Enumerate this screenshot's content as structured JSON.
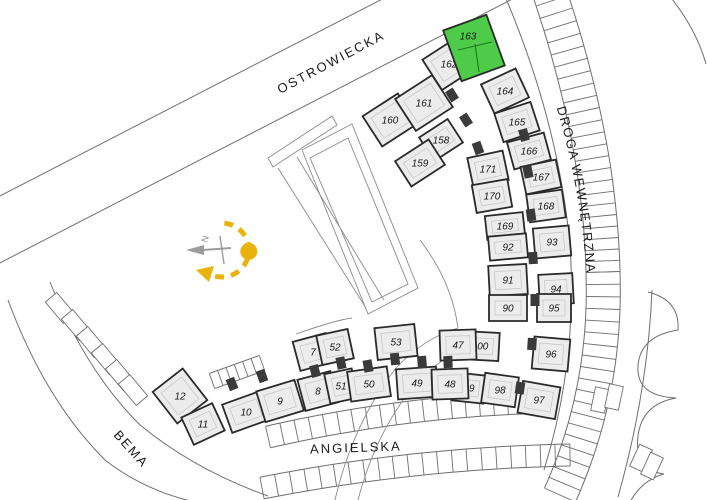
{
  "map": {
    "highlighted_unit": "163",
    "streets": [
      {
        "name": "OSTROWIECKA"
      },
      {
        "name": "DROGA WEWNĘTRZNA"
      },
      {
        "name": "ANGIELSKA"
      },
      {
        "name": "BEMA"
      }
    ],
    "compass": {
      "north_label": "N"
    },
    "colors": {
      "highlight": "#4ecb49",
      "building_fill": "#ececec",
      "building_stroke": "#2a2a2a",
      "text": "#1b1b1b",
      "compass_yellow": "#e9b30b",
      "north_gray": "#9c9c9c"
    },
    "units": [
      {
        "label": "160",
        "x": 390,
        "y": 120,
        "a": -33,
        "w": 42,
        "h": 36
      },
      {
        "label": "161",
        "x": 424,
        "y": 103,
        "a": -33,
        "w": 44,
        "h": 38
      },
      {
        "label": "162",
        "x": 449,
        "y": 64,
        "a": -33,
        "w": 40,
        "h": 36
      },
      {
        "label": "158",
        "x": 441,
        "y": 140,
        "a": -33,
        "w": 34,
        "h": 28
      },
      {
        "label": "159",
        "x": 420,
        "y": 163,
        "a": -33,
        "w": 40,
        "h": 30
      },
      {
        "label": "163",
        "x": 474,
        "y": 48,
        "a": -20,
        "w": 46,
        "h": 54,
        "highlight": true
      },
      {
        "label": "164",
        "x": 505,
        "y": 91,
        "a": -25,
        "w": 38,
        "h": 32
      },
      {
        "label": "165",
        "x": 517,
        "y": 122,
        "a": -18,
        "w": 38,
        "h": 30
      },
      {
        "label": "166",
        "x": 529,
        "y": 151,
        "a": -15,
        "w": 38,
        "h": 28
      },
      {
        "label": "171",
        "x": 488,
        "y": 169,
        "a": -12,
        "w": 36,
        "h": 30
      },
      {
        "label": "167",
        "x": 541,
        "y": 177,
        "a": -12,
        "w": 36,
        "h": 28
      },
      {
        "label": "170",
        "x": 492,
        "y": 196,
        "a": -10,
        "w": 36,
        "h": 28
      },
      {
        "label": "168",
        "x": 546,
        "y": 206,
        "a": -8,
        "w": 36,
        "h": 28
      },
      {
        "label": "169",
        "x": 505,
        "y": 226,
        "a": -6,
        "w": 38,
        "h": 24
      },
      {
        "label": "92",
        "x": 508,
        "y": 247,
        "a": -5,
        "w": 38,
        "h": 24
      },
      {
        "label": "93",
        "x": 552,
        "y": 242,
        "a": -5,
        "w": 36,
        "h": 30
      },
      {
        "label": "91",
        "x": 508,
        "y": 280,
        "a": -3,
        "w": 38,
        "h": 30
      },
      {
        "label": "94",
        "x": 556,
        "y": 289,
        "a": -3,
        "w": 34,
        "h": 30
      },
      {
        "label": "90",
        "x": 508,
        "y": 308,
        "a": 0,
        "w": 38,
        "h": 26
      },
      {
        "label": "95",
        "x": 554,
        "y": 308,
        "a": 0,
        "w": 34,
        "h": 28
      },
      {
        "label": "100",
        "x": 480,
        "y": 346,
        "a": 3,
        "w": 38,
        "h": 28
      },
      {
        "label": "96",
        "x": 551,
        "y": 354,
        "a": 5,
        "w": 36,
        "h": 32
      },
      {
        "label": "99",
        "x": 469,
        "y": 388,
        "a": 6,
        "w": 32,
        "h": 28
      },
      {
        "label": "98",
        "x": 500,
        "y": 390,
        "a": 8,
        "w": 34,
        "h": 30
      },
      {
        "label": "97",
        "x": 539,
        "y": 400,
        "a": 10,
        "w": 38,
        "h": 32
      },
      {
        "label": "12",
        "x": 180,
        "y": 396,
        "a": -38,
        "w": 38,
        "h": 40
      },
      {
        "label": "11",
        "x": 203,
        "y": 424,
        "a": -25,
        "w": 34,
        "h": 30
      },
      {
        "label": "10",
        "x": 246,
        "y": 412,
        "a": -20,
        "w": 40,
        "h": 30
      },
      {
        "label": "9",
        "x": 280,
        "y": 401,
        "a": -17,
        "w": 40,
        "h": 32
      },
      {
        "label": "8",
        "x": 318,
        "y": 391,
        "a": -15,
        "w": 34,
        "h": 32
      },
      {
        "label": "7",
        "x": 313,
        "y": 352,
        "a": -15,
        "w": 34,
        "h": 30
      },
      {
        "label": "52",
        "x": 335,
        "y": 347,
        "a": -12,
        "w": 32,
        "h": 30
      },
      {
        "label": "51",
        "x": 341,
        "y": 386,
        "a": -12,
        "w": 28,
        "h": 30
      },
      {
        "label": "50",
        "x": 369,
        "y": 384,
        "a": -8,
        "w": 40,
        "h": 30
      },
      {
        "label": "53",
        "x": 396,
        "y": 342,
        "a": -6,
        "w": 40,
        "h": 32
      },
      {
        "label": "49",
        "x": 417,
        "y": 383,
        "a": -4,
        "w": 40,
        "h": 30
      },
      {
        "label": "47",
        "x": 458,
        "y": 345,
        "a": -2,
        "w": 36,
        "h": 30
      },
      {
        "label": "48",
        "x": 450,
        "y": 384,
        "a": -2,
        "w": 36,
        "h": 30
      }
    ]
  }
}
